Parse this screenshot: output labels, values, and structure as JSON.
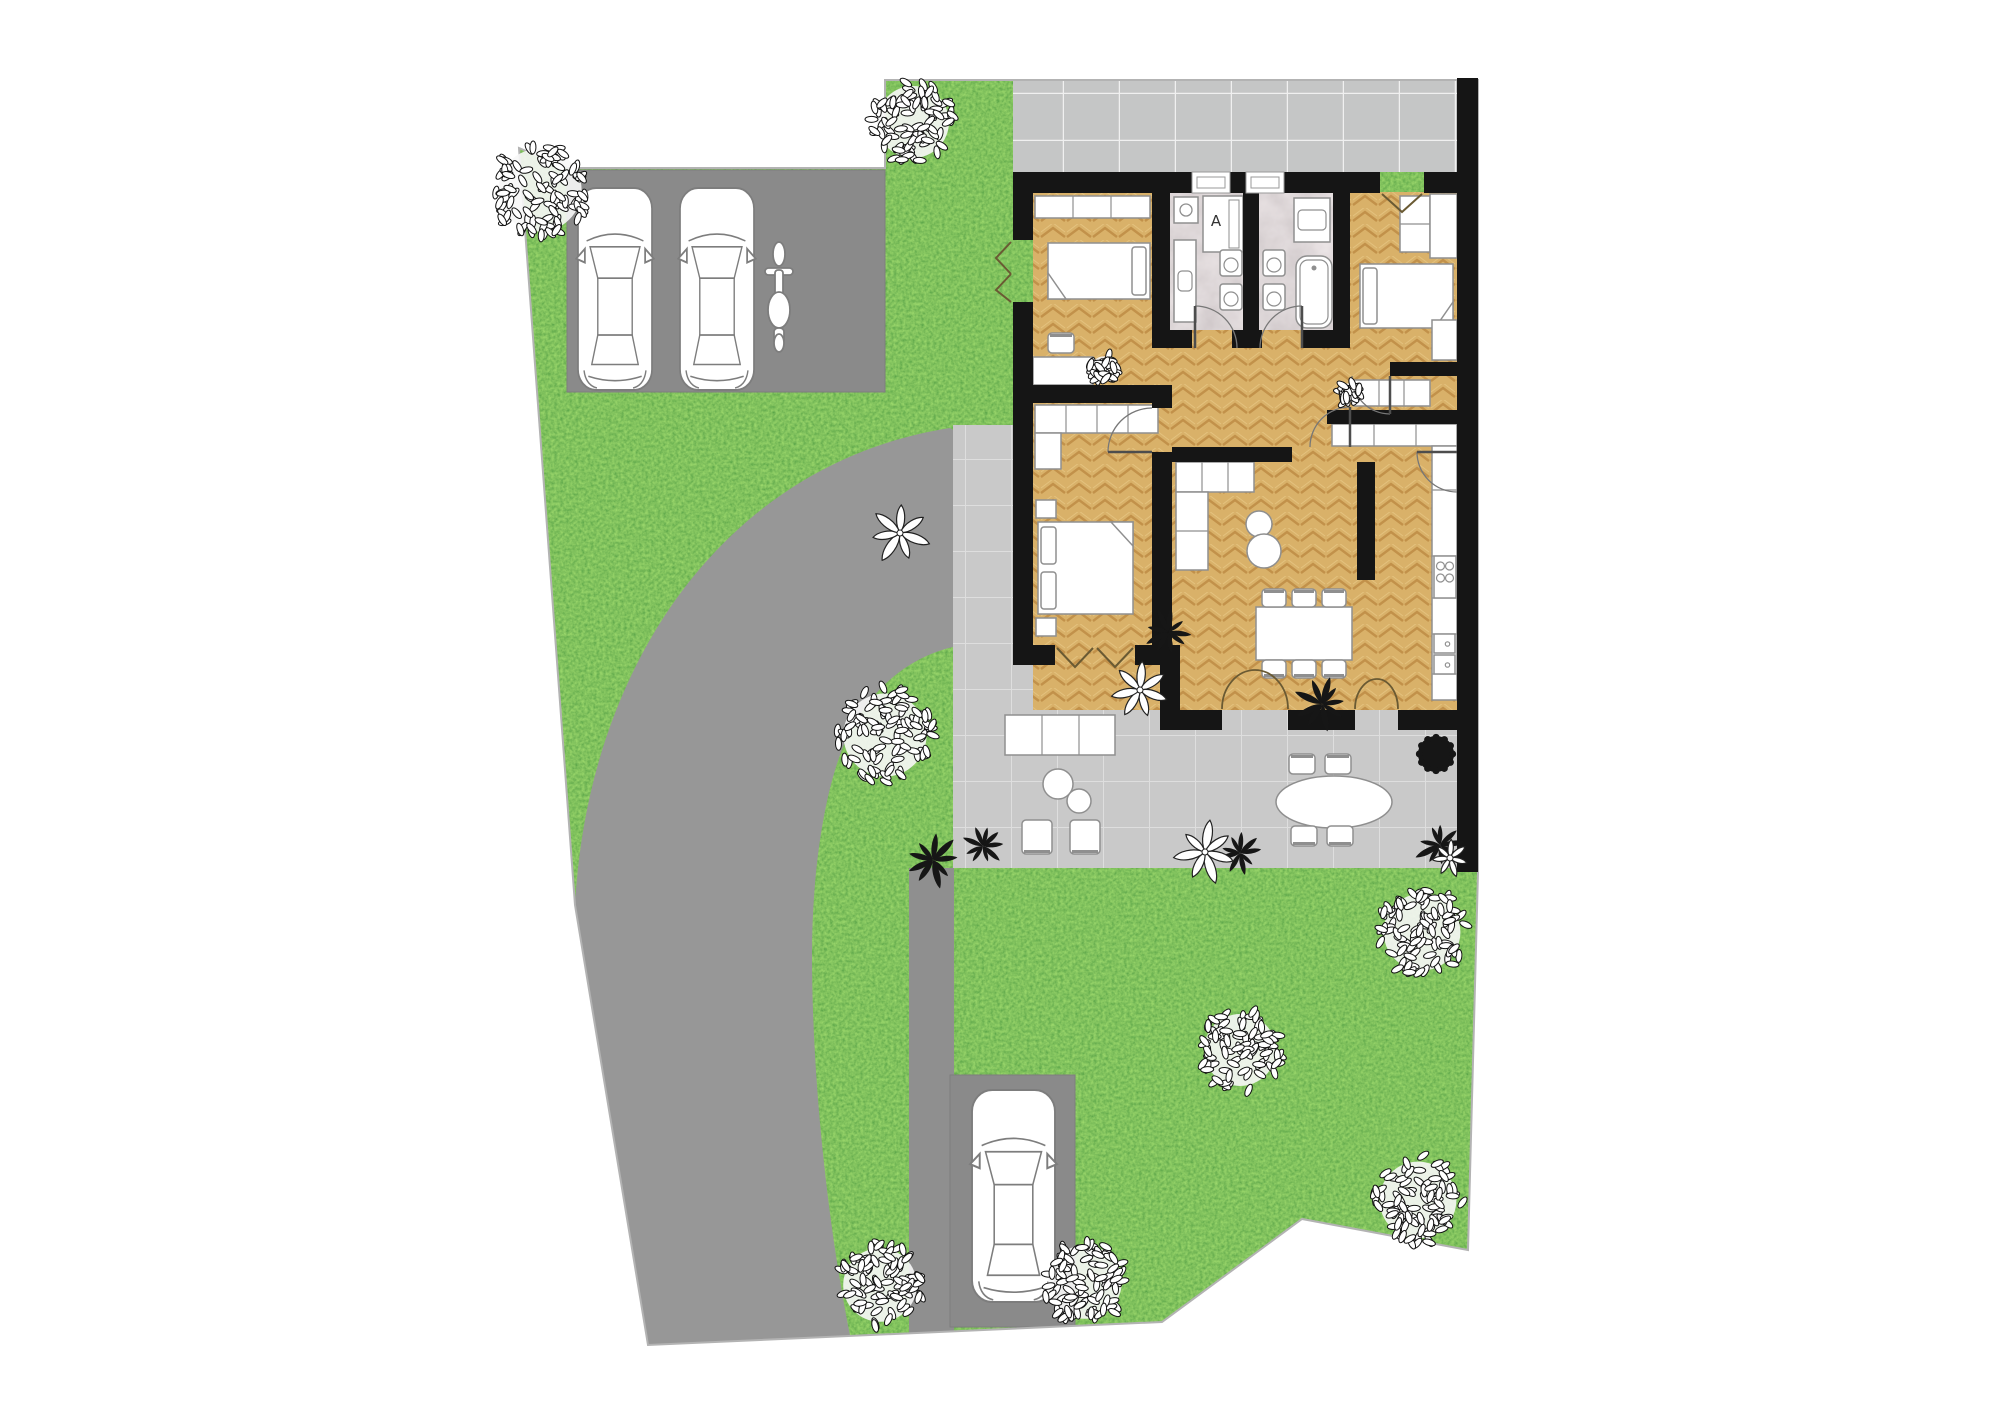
{
  "plan": {
    "size": {
      "w": 2000,
      "h": 1413
    },
    "palette": {
      "background": "#ffffff",
      "grass": "#569631",
      "driveway": "#979797",
      "parking_pad": "#8a8a8a",
      "patio_tile": "#c9c9c9",
      "patio_grout": "#dedede",
      "walkway_tile": "#c5c6c6",
      "walkway_grout": "#f0f0f0",
      "wood_floor": "#d9b169",
      "wood_grain": "#c2914a",
      "marble_floor": "#b7aeb1",
      "wall": "#151515",
      "furniture_fill": "#ffffff",
      "furniture_stroke": "#8f8f8f",
      "boundary_line": "#b3b3b3",
      "door_mark": "#6a5a33",
      "swing_arc": "#777777",
      "plant_dark": "#161616",
      "leaf_outline": "#111111"
    },
    "site": {
      "outline": [
        [
          519,
          148
        ],
        [
          567,
          168
        ],
        [
          885,
          168
        ],
        [
          885,
          80
        ],
        [
          1478,
          80
        ],
        [
          1478,
          872
        ],
        [
          1468,
          1250
        ],
        [
          1302,
          1219
        ],
        [
          1162,
          1322
        ],
        [
          648,
          1345
        ],
        [
          575,
          905
        ]
      ]
    },
    "hardscape": {
      "driveway": {
        "name": "driveway",
        "path": "M575,905 C588,660 730,462 950,428 L953,430 L953,647 C905,658 862,695 840,755 C822,805 812,880 812,955 C812,1080 828,1230 852,1345 L648,1345 Z"
      },
      "lane": {
        "name": "path-to-rear-parking",
        "x": 909,
        "y": 868,
        "w": 45,
        "h": 470
      },
      "parking_pad_top": {
        "name": "parking-pad",
        "x": 567,
        "y": 170,
        "w": 318,
        "h": 222
      },
      "parking_pad_bottom": {
        "name": "rear-parking-pad",
        "x": 950,
        "y": 1075,
        "w": 125,
        "h": 252
      },
      "walkway": {
        "name": "front-walkway",
        "x": 1013,
        "y": 78,
        "w": 444,
        "h": 94
      },
      "patio": {
        "name": "terrace",
        "x": 953,
        "y": 425,
        "w": 504,
        "h": 443
      }
    },
    "house": {
      "floor": {
        "x": 1033,
        "y": 192,
        "w": 424,
        "h": 518
      },
      "bath_floors": [
        {
          "name": "bathroom-1-floor",
          "x": 1170,
          "y": 192,
          "w": 73,
          "h": 138
        },
        {
          "name": "bathroom-2-floor",
          "x": 1259,
          "y": 192,
          "w": 74,
          "h": 138
        }
      ],
      "walls": [
        {
          "n": "top-wall",
          "x": 1013,
          "y": 172,
          "w": 179,
          "h": 21
        },
        {
          "n": "top-wall",
          "x": 1230,
          "y": 172,
          "w": 16,
          "h": 21
        },
        {
          "n": "top-wall",
          "x": 1284,
          "y": 172,
          "w": 96,
          "h": 21
        },
        {
          "n": "top-wall",
          "x": 1424,
          "y": 172,
          "w": 33,
          "h": 21
        },
        {
          "n": "right-wall",
          "x": 1457,
          "y": 78,
          "w": 21,
          "h": 794
        },
        {
          "n": "left-wall",
          "x": 1013,
          "y": 193,
          "w": 20,
          "h": 47
        },
        {
          "n": "left-wall",
          "x": 1013,
          "y": 302,
          "w": 20,
          "h": 363
        },
        {
          "n": "master-bottom-wall",
          "x": 1013,
          "y": 645,
          "w": 42,
          "h": 20
        },
        {
          "n": "master-bottom-wall",
          "x": 1135,
          "y": 645,
          "w": 45,
          "h": 20
        },
        {
          "n": "step-wall",
          "x": 1160,
          "y": 645,
          "w": 20,
          "h": 85
        },
        {
          "n": "living-bottom-wall",
          "x": 1180,
          "y": 710,
          "w": 42,
          "h": 20
        },
        {
          "n": "living-bottom-wall",
          "x": 1288,
          "y": 710,
          "w": 67,
          "h": 20
        },
        {
          "n": "living-bottom-wall",
          "x": 1398,
          "y": 710,
          "w": 59,
          "h": 20
        },
        {
          "n": "bath1-left-wall",
          "x": 1152,
          "y": 193,
          "w": 18,
          "h": 155
        },
        {
          "n": "bath-divider-wall",
          "x": 1243,
          "y": 193,
          "w": 16,
          "h": 155
        },
        {
          "n": "bath2-right-wall",
          "x": 1333,
          "y": 193,
          "w": 17,
          "h": 155
        },
        {
          "n": "bath-bottom-wall",
          "x": 1152,
          "y": 330,
          "w": 40,
          "h": 18
        },
        {
          "n": "bath-bottom-wall",
          "x": 1232,
          "y": 330,
          "w": 30,
          "h": 18
        },
        {
          "n": "bath-bottom-wall",
          "x": 1302,
          "y": 330,
          "w": 48,
          "h": 18
        },
        {
          "n": "bedroom-divider-wall",
          "x": 1033,
          "y": 385,
          "w": 139,
          "h": 18
        },
        {
          "n": "master-right-wall",
          "x": 1152,
          "y": 403,
          "w": 20,
          "h": 5
        },
        {
          "n": "master-right-wall",
          "x": 1152,
          "y": 452,
          "w": 20,
          "h": 196
        },
        {
          "n": "sofa-wall",
          "x": 1172,
          "y": 447,
          "w": 120,
          "h": 15
        },
        {
          "n": "corridor-wall",
          "x": 1390,
          "y": 362,
          "w": 67,
          "h": 14
        },
        {
          "n": "kitchen-top-wall",
          "x": 1327,
          "y": 410,
          "w": 130,
          "h": 14
        },
        {
          "n": "kitchen-divider-wall",
          "x": 1357,
          "y": 462,
          "w": 18,
          "h": 118
        }
      ],
      "windows": [
        {
          "name": "window",
          "x": 1192,
          "y": 172,
          "w": 38,
          "h": 21
        },
        {
          "name": "window",
          "x": 1246,
          "y": 172,
          "w": 38,
          "h": 21
        }
      ],
      "labels": {
        "shower_symbol": "A"
      }
    },
    "door_marks": {
      "v_marks": [
        {
          "n": "patio-door-leaf",
          "pts": [
            [
              1057,
              648
            ],
            [
              1075,
              667
            ],
            [
              1093,
              648
            ]
          ]
        },
        {
          "n": "patio-door-leaf",
          "pts": [
            [
              1097,
              648
            ],
            [
              1115,
              667
            ],
            [
              1133,
              648
            ]
          ]
        },
        {
          "n": "entry-door-leaf",
          "pts": [
            [
              1382,
              194
            ],
            [
              1402,
              212
            ],
            [
              1422,
              194
            ]
          ]
        },
        {
          "n": "side-door-leaf",
          "pts": [
            [
              1011,
              242
            ],
            [
              996,
              258
            ],
            [
              1011,
              274
            ]
          ]
        },
        {
          "n": "side-door-leaf",
          "pts": [
            [
              1011,
              274
            ],
            [
              996,
              290
            ],
            [
              1011,
              302
            ]
          ]
        }
      ],
      "arcs": [
        {
          "n": "bath1-door-swing",
          "d": "M1237,348 A42 42 0 0 0 1195,306",
          "leaf": "M1195,348 L1195,306"
        },
        {
          "n": "bath2-door-swing",
          "d": "M1260,348 A42 42 0 0 1 1302,306",
          "leaf": "M1302,348 L1302,306"
        },
        {
          "n": "master-door-swing",
          "d": "M1152,408 A44 44 0 0 0 1108,452",
          "leaf": "M1152,452 L1108,452"
        },
        {
          "n": "bedroom2-door-swing",
          "d": "M1352,376 A38 38 0 0 0 1390,414",
          "leaf": "M1390,376 L1390,414"
        },
        {
          "n": "kitchen-side-door-swing",
          "d": "M1457,492 A40 40 0 0 1 1417,452",
          "leaf": "M1457,452 L1417,452"
        },
        {
          "n": "hall-living-door-swing",
          "d": "M1310,447 A40 40 0 0 1 1350,407",
          "leaf": "M1350,447 L1350,407"
        }
      ],
      "curtains": [
        {
          "n": "living-french-door",
          "d": "M1222,709 A33 39 0 0 1 1255,670"
        },
        {
          "n": "living-french-door",
          "d": "M1288,709 A33 39 0 0 0 1255,670"
        },
        {
          "n": "kitchen-french-door",
          "d": "M1355,709 A22 30 0 0 1 1377,679"
        },
        {
          "n": "kitchen-french-door",
          "d": "M1398,709 A21 30 0 0 0 1377,679"
        }
      ]
    },
    "furniture": [
      {
        "t": "counter",
        "n": "wardrobe",
        "x": 1035,
        "y": 196,
        "w": 115,
        "h": 22,
        "dv": [
          1073,
          1111
        ]
      },
      {
        "t": "bed",
        "n": "single-bed",
        "x": 1048,
        "y": 243,
        "w": 102,
        "h": 56,
        "pillow": "right",
        "fold": "bl"
      },
      {
        "t": "rect",
        "n": "desk",
        "x": 1033,
        "y": 357,
        "w": 60,
        "h": 28
      },
      {
        "t": "chair",
        "n": "desk-chair",
        "cx": 1061,
        "cy": 343,
        "w": 26,
        "h": 20,
        "back": "up"
      },
      {
        "t": "washer",
        "n": "washing-machine",
        "x": 1174,
        "y": 197,
        "w": 24,
        "h": 26
      },
      {
        "t": "shower",
        "n": "shower",
        "x": 1203,
        "y": 196,
        "w": 40,
        "h": 56
      },
      {
        "t": "basin",
        "n": "washbasin",
        "x": 1174,
        "y": 240,
        "w": 22,
        "h": 82
      },
      {
        "t": "wc",
        "n": "toilet",
        "x": 1220,
        "y": 250,
        "w": 22,
        "h": 26
      },
      {
        "t": "wc",
        "n": "bidet",
        "x": 1220,
        "y": 284,
        "w": 22,
        "h": 26
      },
      {
        "t": "basin",
        "n": "washbasin",
        "x": 1294,
        "y": 198,
        "w": 36,
        "h": 44
      },
      {
        "t": "wc",
        "n": "toilet",
        "x": 1263,
        "y": 250,
        "w": 22,
        "h": 26
      },
      {
        "t": "wc",
        "n": "bidet",
        "x": 1263,
        "y": 284,
        "w": 22,
        "h": 26
      },
      {
        "t": "tub",
        "n": "bathtub",
        "x": 1296,
        "y": 256,
        "w": 36,
        "h": 72
      },
      {
        "t": "counter",
        "n": "wardrobe",
        "x": 1400,
        "y": 196,
        "w": 30,
        "h": 56,
        "dh": [
          224
        ]
      },
      {
        "t": "rect",
        "n": "closet",
        "x": 1430,
        "y": 194,
        "w": 27,
        "h": 64
      },
      {
        "t": "bed",
        "n": "single-bed",
        "x": 1360,
        "y": 264,
        "w": 93,
        "h": 64,
        "pillow": "left",
        "fold": "br"
      },
      {
        "t": "counter",
        "n": "wardrobe",
        "x": 1432,
        "y": 320,
        "w": 25,
        "h": 40
      },
      {
        "t": "counter",
        "n": "sideboard",
        "x": 1354,
        "y": 380,
        "w": 76,
        "h": 26,
        "dv": [
          1379,
          1404
        ]
      },
      {
        "t": "counter",
        "n": "wardrobe",
        "x": 1035,
        "y": 405,
        "w": 123,
        "h": 28,
        "dv": [
          1066,
          1097,
          1128
        ]
      },
      {
        "t": "counter",
        "n": "wardrobe",
        "x": 1035,
        "y": 433,
        "w": 26,
        "h": 36
      },
      {
        "t": "rect",
        "n": "nightstand",
        "x": 1036,
        "y": 500,
        "w": 20,
        "h": 18
      },
      {
        "t": "rect",
        "n": "nightstand",
        "x": 1036,
        "y": 618,
        "w": 20,
        "h": 18
      },
      {
        "t": "bed",
        "n": "double-bed",
        "x": 1038,
        "y": 522,
        "w": 95,
        "h": 92,
        "pillow": "left",
        "double": true,
        "fold": "tr"
      },
      {
        "t": "counter",
        "n": "sofa",
        "x": 1176,
        "y": 462,
        "w": 78,
        "h": 30,
        "dv": [
          1202,
          1228
        ]
      },
      {
        "t": "counter",
        "n": "sofa-chaise",
        "x": 1176,
        "y": 492,
        "w": 32,
        "h": 78,
        "dh": [
          531
        ]
      },
      {
        "t": "circle",
        "n": "coffee-table",
        "cx": 1259,
        "cy": 524,
        "r": 13
      },
      {
        "t": "circle",
        "n": "coffee-table",
        "cx": 1264,
        "cy": 551,
        "r": 17
      },
      {
        "t": "rect",
        "n": "dining-table",
        "x": 1256,
        "y": 607,
        "w": 96,
        "h": 53
      },
      {
        "t": "chair",
        "n": "dining-chair",
        "cx": 1274,
        "cy": 598,
        "w": 24,
        "h": 18,
        "back": "up"
      },
      {
        "t": "chair",
        "n": "dining-chair",
        "cx": 1304,
        "cy": 598,
        "w": 24,
        "h": 18,
        "back": "up"
      },
      {
        "t": "chair",
        "n": "dining-chair",
        "cx": 1334,
        "cy": 598,
        "w": 24,
        "h": 18,
        "back": "up"
      },
      {
        "t": "chair",
        "n": "dining-chair",
        "cx": 1274,
        "cy": 669,
        "w": 24,
        "h": 18,
        "back": "down"
      },
      {
        "t": "chair",
        "n": "dining-chair",
        "cx": 1304,
        "cy": 669,
        "w": 24,
        "h": 18,
        "back": "down"
      },
      {
        "t": "chair",
        "n": "dining-chair",
        "cx": 1334,
        "cy": 669,
        "w": 24,
        "h": 18,
        "back": "down"
      },
      {
        "t": "counter",
        "n": "kitchen-counter",
        "x": 1332,
        "y": 424,
        "w": 125,
        "h": 22,
        "dv": [
          1374,
          1416
        ]
      },
      {
        "t": "counter",
        "n": "kitchen-counter",
        "x": 1432,
        "y": 446,
        "w": 25,
        "h": 254,
        "dh": [
          490,
          556,
          598,
          634,
          674
        ]
      },
      {
        "t": "stove",
        "n": "stove",
        "x": 1434,
        "y": 556,
        "w": 22,
        "h": 42
      },
      {
        "t": "sink2",
        "n": "kitchen-sink",
        "x": 1434,
        "y": 634,
        "w": 21,
        "h": 40
      },
      {
        "t": "counter",
        "n": "outdoor-sofa",
        "x": 1005,
        "y": 715,
        "w": 110,
        "h": 40,
        "dv": [
          1042,
          1079
        ]
      },
      {
        "t": "circle",
        "n": "outdoor-table",
        "cx": 1058,
        "cy": 784,
        "r": 15
      },
      {
        "t": "circle",
        "n": "outdoor-table",
        "cx": 1079,
        "cy": 801,
        "r": 12
      },
      {
        "t": "chair",
        "n": "armchair",
        "cx": 1037,
        "cy": 837,
        "w": 30,
        "h": 34,
        "back": "down"
      },
      {
        "t": "chair",
        "n": "armchair",
        "cx": 1085,
        "cy": 837,
        "w": 30,
        "h": 34,
        "back": "down"
      },
      {
        "t": "ellipse",
        "n": "patio-dining-table",
        "cx": 1334,
        "cy": 802,
        "rx": 58,
        "ry": 26
      },
      {
        "t": "chair",
        "n": "patio-chair",
        "cx": 1302,
        "cy": 764,
        "w": 26,
        "h": 20,
        "back": "up"
      },
      {
        "t": "chair",
        "n": "patio-chair",
        "cx": 1338,
        "cy": 764,
        "w": 26,
        "h": 20,
        "back": "up"
      },
      {
        "t": "chair",
        "n": "patio-chair",
        "cx": 1304,
        "cy": 836,
        "w": 26,
        "h": 20,
        "back": "down"
      },
      {
        "t": "chair",
        "n": "patio-chair",
        "cx": 1340,
        "cy": 836,
        "w": 26,
        "h": 20,
        "back": "down"
      }
    ],
    "vegetation": {
      "trees": [
        {
          "cx": 540,
          "cy": 190,
          "r": 52
        },
        {
          "cx": 913,
          "cy": 122,
          "r": 45
        },
        {
          "cx": 885,
          "cy": 735,
          "r": 52
        },
        {
          "cx": 1422,
          "cy": 932,
          "r": 48
        },
        {
          "cx": 1240,
          "cy": 1050,
          "r": 45
        },
        {
          "cx": 1418,
          "cy": 1200,
          "r": 48
        },
        {
          "cx": 1085,
          "cy": 1282,
          "r": 46
        },
        {
          "cx": 880,
          "cy": 1285,
          "r": 46
        }
      ],
      "mini_trees": [
        {
          "cx": 1104,
          "cy": 369,
          "r": 16
        },
        {
          "cx": 1349,
          "cy": 393,
          "r": 12
        }
      ],
      "dark_plants": [
        {
          "cx": 1168,
          "cy": 632,
          "r": 22
        },
        {
          "cx": 1322,
          "cy": 704,
          "r": 26
        },
        {
          "cx": 933,
          "cy": 860,
          "r": 26
        },
        {
          "cx": 983,
          "cy": 846,
          "r": 20
        },
        {
          "cx": 1440,
          "cy": 845,
          "r": 24
        },
        {
          "cx": 1240,
          "cy": 853,
          "r": 20
        }
      ],
      "white_flowers": [
        {
          "cx": 900,
          "cy": 533,
          "r": 30
        },
        {
          "cx": 1140,
          "cy": 690,
          "r": 30
        },
        {
          "cx": 1205,
          "cy": 852,
          "r": 30
        },
        {
          "cx": 1450,
          "cy": 858,
          "r": 18
        }
      ],
      "bushes": [
        {
          "cx": 1436,
          "cy": 754,
          "r": 18
        }
      ]
    },
    "vehicles": {
      "cars": [
        {
          "n": "parked-car",
          "x": 578,
          "y": 188,
          "w": 74,
          "h": 202
        },
        {
          "n": "parked-car",
          "x": 680,
          "y": 188,
          "w": 74,
          "h": 202
        },
        {
          "n": "parked-car",
          "x": 972,
          "y": 1090,
          "w": 83,
          "h": 212
        }
      ],
      "scooters": [
        {
          "n": "scooter",
          "x": 762,
          "y": 240,
          "w": 34,
          "h": 112
        }
      ]
    }
  }
}
